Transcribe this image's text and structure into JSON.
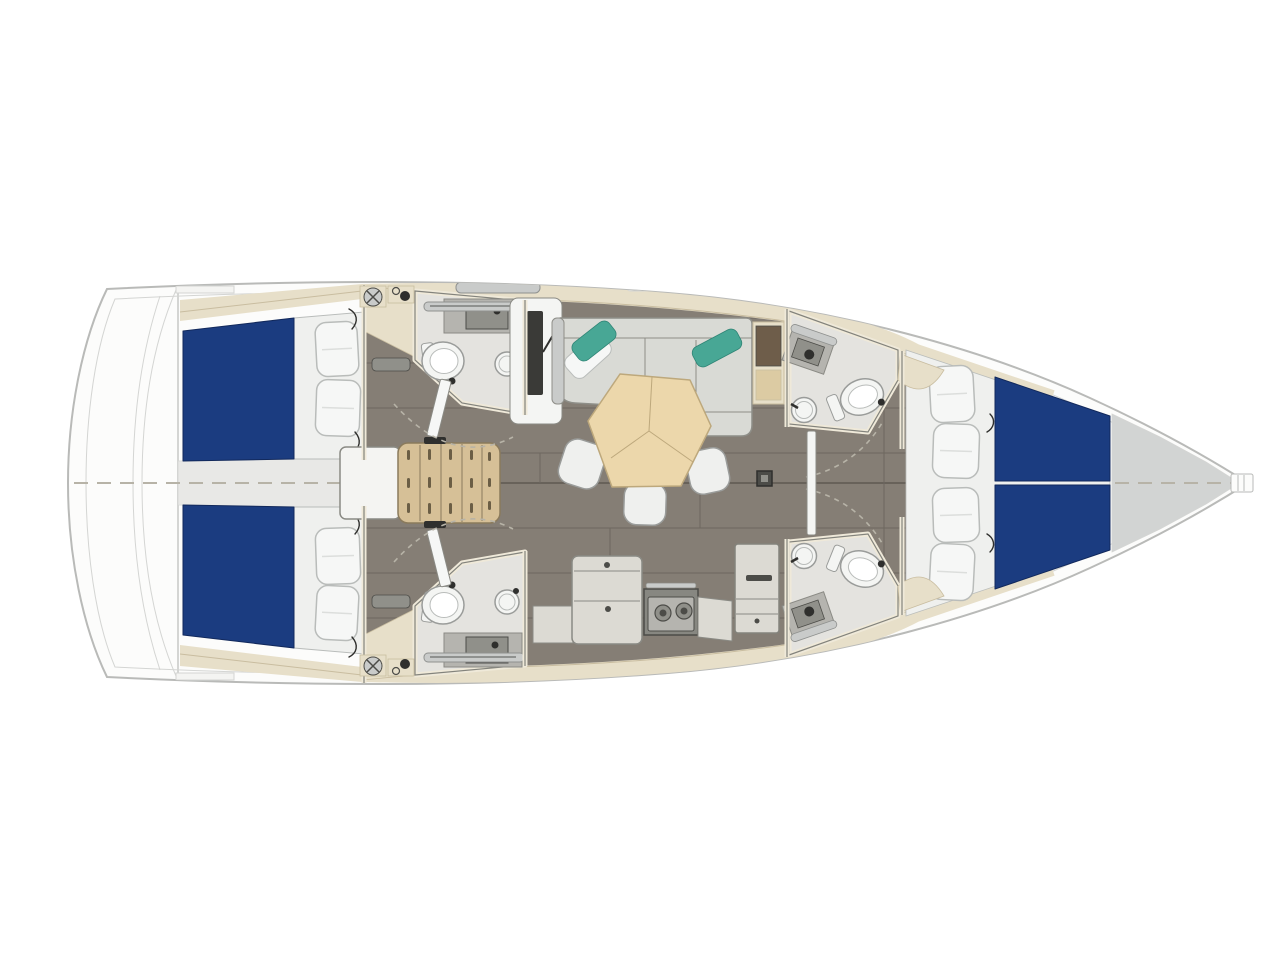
{
  "image": {
    "kind": "sailing-yacht-interior-layout-plan",
    "view": "top-down",
    "orientation": "stern at left, bow at right"
  },
  "layout_summary": {
    "cabins": 3,
    "heads": 4,
    "companionway_steps": 5,
    "saloon": "L-shaped sofa with pentagonal table and three stools",
    "galley": "two-burner stove with counters and tall locker"
  },
  "areas": [
    {
      "id": "swim-platform",
      "label": "Stern platform / lazarette"
    },
    {
      "id": "aft-cabin-port",
      "label": "Aft double cabin (port)"
    },
    {
      "id": "aft-cabin-starboard",
      "label": "Aft double cabin (starboard)"
    },
    {
      "id": "aft-head-port",
      "label": "Aft head (port)"
    },
    {
      "id": "aft-head-starboard",
      "label": "Aft head (starboard)"
    },
    {
      "id": "companionway",
      "label": "Companionway steps"
    },
    {
      "id": "saloon",
      "label": "Saloon"
    },
    {
      "id": "galley",
      "label": "Galley"
    },
    {
      "id": "forward-head-port",
      "label": "Forward head (port)"
    },
    {
      "id": "forward-head-starboard",
      "label": "Forward head (starboard)"
    },
    {
      "id": "forward-cabin",
      "label": "Forward cabin with V-berth"
    },
    {
      "id": "bow-locker",
      "label": "Bow anchor fitting"
    }
  ],
  "palette": {
    "bg": "#ffffff",
    "hull_fill": "#fcfcfb",
    "hull_stroke": "#b9bab8",
    "hull_inner": "#d4d5d3",
    "deck_white": "#f4f4f2",
    "band": "#e7dfc9",
    "band_line": "#c9bda0",
    "floor": "#857e75",
    "floor_seam": "#6d675f",
    "floor_center": "#5f5952",
    "walkway": "#e8e8e6",
    "room": "#e4e3df",
    "wall_cream": "#efe9d9",
    "wall_dark": "#83837c",
    "bed_blue": "#1b3c80",
    "bed_edge": "#12295c",
    "linen": "#eff0ee",
    "pillow": "#f6f7f6",
    "pillow_edge": "#b9bcba",
    "teal": "#48a795",
    "teal_edge": "#2f8475",
    "sofa": "#d9dad5",
    "sofa_edge": "#8e8e88",
    "table": "#ecd7ab",
    "table_edge": "#bda87c",
    "stairs": "#d6c097",
    "stairs_edge": "#8a7a5c",
    "counter": "#dcdad3",
    "counter_edge": "#8a8a84",
    "counter_dark": "#b5b4af",
    "sink_dark": "#90908a",
    "appliance": "#878781",
    "appliance_dark": "#4c4c48",
    "fixture": "#f4f5f3",
    "fixture_edge": "#9a9c9a",
    "bow_gray": "#d2d4d3",
    "dark_panel": "#3a3a37",
    "hardware": "#2f2f2d",
    "dashes": "#b7b3a7",
    "gray_bar": "#c9cbca",
    "gray_bar_edge": "#8f918f",
    "cabinet_top": "#6e5d4a",
    "cabinet_door": "#dccba3"
  }
}
